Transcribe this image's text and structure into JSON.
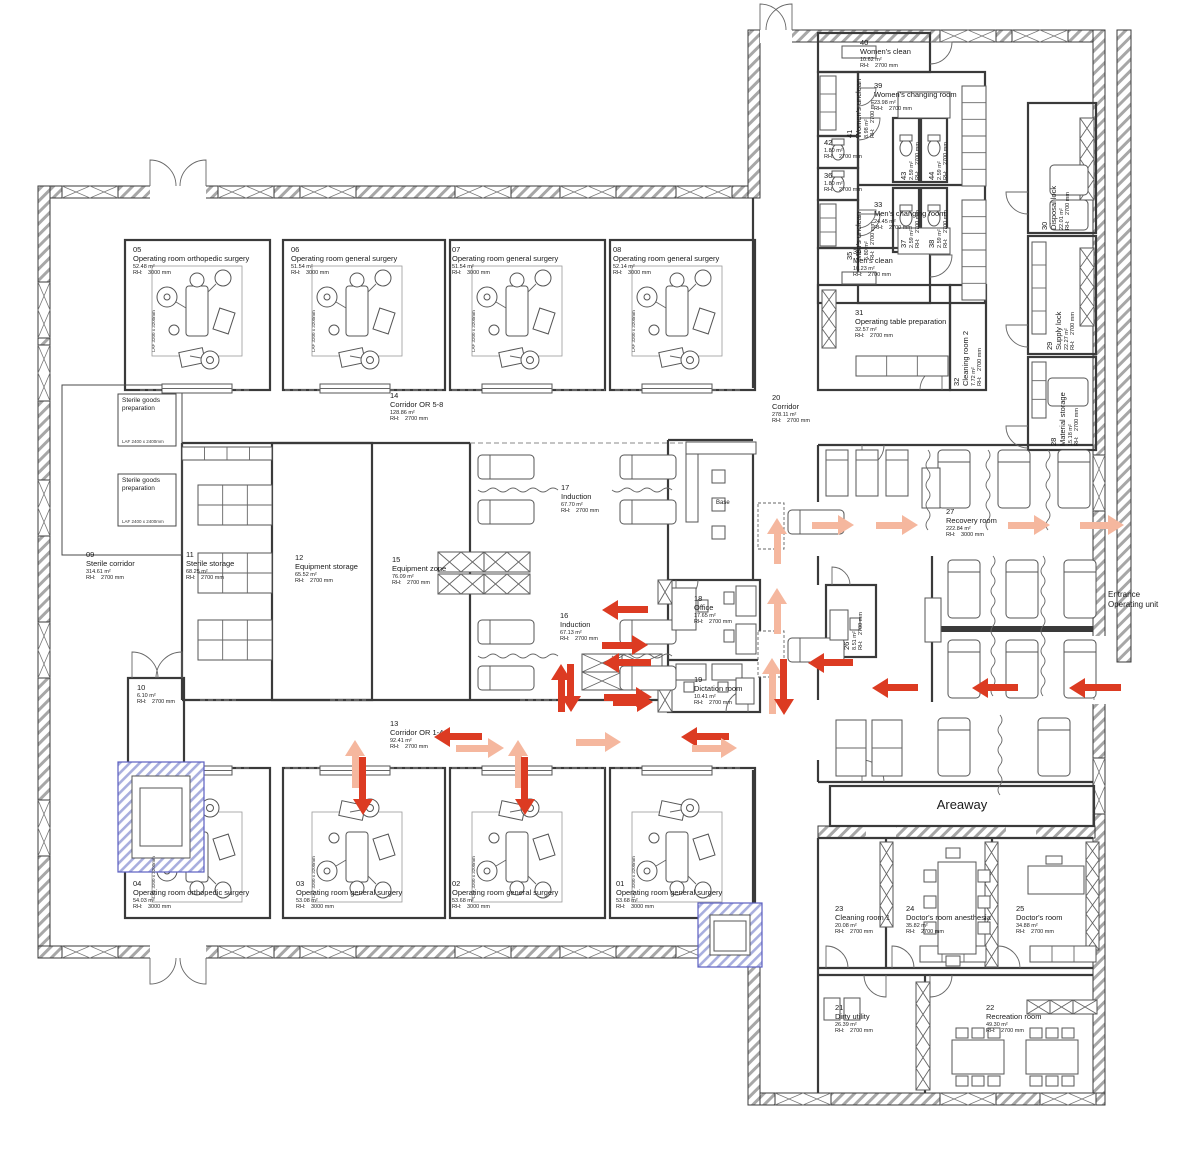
{
  "palette": {
    "wall": "#3a3a3a",
    "arrow_dark": "#dc3b22",
    "arrow_light": "#f5b79e",
    "elevator_hatch": "#a8aede",
    "wall_hatch": "#a7a7a7"
  },
  "labels": {
    "areaway": "Areaway",
    "entrance": "Entrance\nOperating unit",
    "base": "Base",
    "rh_prefix": "RH:",
    "sterile_goods": "Sterile goods\npreparation",
    "sterile_goods_laf": "LAF\n2400 x 2400mm",
    "or_laf": "LAF 3200 x 3200mm"
  },
  "rooms": [
    {
      "n": "01",
      "name": "Operating room general surgery",
      "area": "53.68 m²",
      "rh": "3000 mm",
      "x": 616,
      "y": 880
    },
    {
      "n": "02",
      "name": "Operating room general surgery",
      "area": "53.68 m²",
      "rh": "3000 mm",
      "x": 452,
      "y": 880
    },
    {
      "n": "03",
      "name": "Operating room general surgery",
      "area": "53.08 m²",
      "rh": "3000 mm",
      "x": 296,
      "y": 880
    },
    {
      "n": "04",
      "name": "Operating room orthopedic surgery",
      "area": "54.03 m²",
      "rh": "3000 mm",
      "x": 133,
      "y": 880
    },
    {
      "n": "05",
      "name": "Operating room orthopedic surgery",
      "area": "52.48 m²",
      "rh": "3000 mm",
      "x": 133,
      "y": 246
    },
    {
      "n": "06",
      "name": "Operating room general surgery",
      "area": "51.54 m²",
      "rh": "3000 mm",
      "x": 291,
      "y": 246
    },
    {
      "n": "07",
      "name": "Operating room general surgery",
      "area": "51.54 m²",
      "rh": "3000 mm",
      "x": 452,
      "y": 246
    },
    {
      "n": "08",
      "name": "Operating room general surgery",
      "area": "52.14 m²",
      "rh": "3000 mm",
      "x": 613,
      "y": 246
    },
    {
      "n": "09",
      "name": "Sterile corridor",
      "area": "314.61 m²",
      "rh": "2700 mm",
      "x": 86,
      "y": 551
    },
    {
      "n": "10",
      "name": "",
      "area": "6.10 m²",
      "rh": "2700 mm",
      "x": 137,
      "y": 684
    },
    {
      "n": "11",
      "name": "Sterile storage",
      "area": "68.25 m²",
      "rh": "2700 mm",
      "x": 186,
      "y": 551
    },
    {
      "n": "12",
      "name": "Equipment storage",
      "area": "65.52 m²",
      "rh": "2700 mm",
      "x": 295,
      "y": 554
    },
    {
      "n": "13",
      "name": "Corridor OR 1-4",
      "area": "92.41 m²",
      "rh": "2700 mm",
      "x": 390,
      "y": 720
    },
    {
      "n": "14",
      "name": "Corridor OR 5-8",
      "area": "128.86 m²",
      "rh": "2700 mm",
      "x": 390,
      "y": 392
    },
    {
      "n": "15",
      "name": "Equipment zone",
      "area": "76.09 m²",
      "rh": "2700 mm",
      "x": 392,
      "y": 556
    },
    {
      "n": "16",
      "name": "Induction",
      "area": "67.13 m²",
      "rh": "2700 mm",
      "x": 560,
      "y": 612
    },
    {
      "n": "17",
      "name": "Induction",
      "area": "67.70 m²",
      "rh": "2700 mm",
      "x": 561,
      "y": 484
    },
    {
      "n": "18",
      "name": "Office",
      "area": "17.65 m²",
      "rh": "2700 mm",
      "x": 694,
      "y": 595
    },
    {
      "n": "19",
      "name": "Dictation room",
      "area": "10.41 m²",
      "rh": "2700 mm",
      "x": 694,
      "y": 676
    },
    {
      "n": "20",
      "name": "Corridor",
      "area": "278.11 m²",
      "rh": "2700 mm",
      "x": 772,
      "y": 394
    },
    {
      "n": "21",
      "name": "Dirty utility",
      "area": "26.39 m²",
      "rh": "2700 mm",
      "x": 835,
      "y": 1004
    },
    {
      "n": "22",
      "name": "Recreation room",
      "area": "49.30 m²",
      "rh": "2700 mm",
      "x": 986,
      "y": 1004
    },
    {
      "n": "23",
      "name": "Cleaning room 1",
      "area": "20.08 m²",
      "rh": "2700 mm",
      "x": 835,
      "y": 905
    },
    {
      "n": "24",
      "name": "Doctor's room anesthesia",
      "area": "35.82 m²",
      "rh": "2700 mm",
      "x": 906,
      "y": 905
    },
    {
      "n": "25",
      "name": "Doctor's room",
      "area": "34.88 m²",
      "rh": "2700 mm",
      "x": 1016,
      "y": 905
    },
    {
      "n": "26",
      "name": "",
      "area": "8.51 m²",
      "rh": "2700 mm",
      "x": 843,
      "y": 650,
      "v": true
    },
    {
      "n": "27",
      "name": "Recovery room",
      "area": "222.84 m²",
      "rh": "3000 mm",
      "x": 946,
      "y": 508
    },
    {
      "n": "28",
      "name": "Material storage",
      "area": "15.18 m²",
      "rh": "2700 mm",
      "x": 1050,
      "y": 446,
      "v": true
    },
    {
      "n": "29",
      "name": "Supply lock",
      "area": "22.27 m²",
      "rh": "2700 mm",
      "x": 1046,
      "y": 350,
      "v": true
    },
    {
      "n": "30",
      "name": "Disposal lock",
      "area": "22.01 m²",
      "rh": "2700 mm",
      "x": 1041,
      "y": 230,
      "v": true
    },
    {
      "n": "31",
      "name": "Operating table preparation",
      "area": "32.57 m²",
      "rh": "2700 mm",
      "x": 855,
      "y": 309
    },
    {
      "n": "32",
      "name": "Cleaning room 2",
      "area": "7.72 m²",
      "rh": "2700 mm",
      "x": 953,
      "y": 386,
      "v": true
    },
    {
      "n": "33",
      "name": "Men's changing room",
      "area": "24.45 m²",
      "rh": "2700 mm",
      "x": 874,
      "y": 201
    },
    {
      "n": "34",
      "name": "Men's clean",
      "area": "10.23 m²",
      "rh": "2700 mm",
      "x": 853,
      "y": 248
    },
    {
      "n": "35",
      "name": "Men's unclean",
      "area": "5.80 m²",
      "rh": "2700 mm",
      "x": 846,
      "y": 260,
      "v": true
    },
    {
      "n": "36",
      "name": "",
      "area": "1.80 m²",
      "rh": "2700 mm",
      "x": 824,
      "y": 172
    },
    {
      "n": "37",
      "name": "",
      "area": "2.59 m²",
      "rh": "2700 mm",
      "x": 900,
      "y": 248,
      "v": true
    },
    {
      "n": "38",
      "name": "",
      "area": "2.59 m²",
      "rh": "2700 mm",
      "x": 928,
      "y": 248,
      "v": true
    },
    {
      "n": "39",
      "name": "Women's changing room",
      "area": "23.98 m²",
      "rh": "2700 mm",
      "x": 874,
      "y": 82
    },
    {
      "n": "40",
      "name": "Women's clean",
      "area": "10.62 m²",
      "rh": "2700 mm",
      "x": 860,
      "y": 39
    },
    {
      "n": "41",
      "name": "Women's unclean",
      "area": "8.98 m²",
      "rh": "2700 mm",
      "x": 846,
      "y": 138,
      "v": true
    },
    {
      "n": "42",
      "name": "",
      "area": "1.80 m²",
      "rh": "2700 mm",
      "x": 824,
      "y": 139
    },
    {
      "n": "43",
      "name": "",
      "area": "2.59 m²",
      "rh": "2700 mm",
      "x": 900,
      "y": 180,
      "v": true
    },
    {
      "n": "44",
      "name": "",
      "area": "2.59 m²",
      "rh": "2700 mm",
      "x": 928,
      "y": 180,
      "v": true
    }
  ],
  "laf_tags": [
    [
      151,
      352
    ],
    [
      311,
      352
    ],
    [
      471,
      352
    ],
    [
      631,
      352
    ],
    [
      151,
      898
    ],
    [
      311,
      898
    ],
    [
      471,
      898
    ],
    [
      631,
      898
    ]
  ],
  "arrows": [
    {
      "x": 812,
      "y": 525,
      "dir": "right",
      "tone": "light",
      "len": 42
    },
    {
      "x": 876,
      "y": 525,
      "dir": "right",
      "tone": "light",
      "len": 42
    },
    {
      "x": 1008,
      "y": 525,
      "dir": "right",
      "tone": "light",
      "len": 42
    },
    {
      "x": 1080,
      "y": 525,
      "dir": "right",
      "tone": "light",
      "len": 44
    },
    {
      "x": 777,
      "y": 564,
      "dir": "up",
      "tone": "light",
      "len": 46
    },
    {
      "x": 777,
      "y": 634,
      "dir": "up",
      "tone": "light",
      "len": 46
    },
    {
      "x": 772,
      "y": 714,
      "dir": "up",
      "tone": "light",
      "len": 56
    },
    {
      "x": 784,
      "y": 659,
      "dir": "down",
      "tone": "dark",
      "len": 56
    },
    {
      "x": 853,
      "y": 663,
      "dir": "left",
      "tone": "dark",
      "len": 45
    },
    {
      "x": 918,
      "y": 688,
      "dir": "left",
      "tone": "dark",
      "len": 46
    },
    {
      "x": 1018,
      "y": 688,
      "dir": "left",
      "tone": "dark",
      "len": 46
    },
    {
      "x": 1121,
      "y": 688,
      "dir": "left",
      "tone": "dark",
      "len": 52
    },
    {
      "x": 648,
      "y": 610,
      "dir": "left",
      "tone": "dark",
      "len": 46
    },
    {
      "x": 602,
      "y": 645,
      "dir": "right",
      "tone": "dark",
      "len": 46
    },
    {
      "x": 651,
      "y": 663,
      "dir": "left",
      "tone": "dark",
      "len": 48
    },
    {
      "x": 604,
      "y": 697,
      "dir": "right",
      "tone": "dark",
      "len": 48
    },
    {
      "x": 561,
      "y": 712,
      "dir": "up",
      "tone": "dark",
      "len": 48
    },
    {
      "x": 571,
      "y": 664,
      "dir": "down",
      "tone": "dark",
      "len": 48
    },
    {
      "x": 613,
      "y": 702,
      "dir": "right",
      "tone": "dark",
      "len": 40
    },
    {
      "x": 482,
      "y": 737,
      "dir": "left",
      "tone": "dark",
      "len": 48
    },
    {
      "x": 456,
      "y": 748,
      "dir": "right",
      "tone": "light",
      "len": 48
    },
    {
      "x": 576,
      "y": 742,
      "dir": "right",
      "tone": "light",
      "len": 45
    },
    {
      "x": 729,
      "y": 737,
      "dir": "left",
      "tone": "dark",
      "len": 48
    },
    {
      "x": 692,
      "y": 748,
      "dir": "right",
      "tone": "light",
      "len": 45
    },
    {
      "x": 355,
      "y": 788,
      "dir": "up",
      "tone": "light",
      "len": 48
    },
    {
      "x": 363,
      "y": 757,
      "dir": "down",
      "tone": "dark",
      "len": 58
    },
    {
      "x": 518,
      "y": 788,
      "dir": "up",
      "tone": "light",
      "len": 48
    },
    {
      "x": 525,
      "y": 757,
      "dir": "down",
      "tone": "dark",
      "len": 58
    }
  ]
}
